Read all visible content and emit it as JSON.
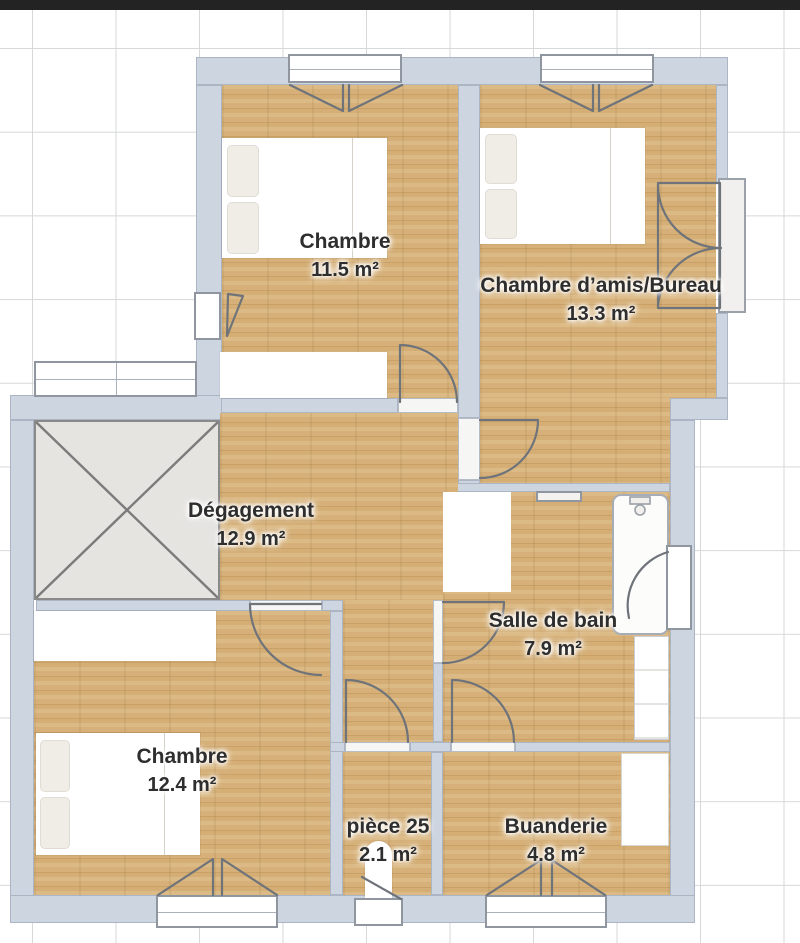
{
  "rooms": [
    {
      "id": "chambre-1",
      "name": "Chambre",
      "area": "11.5 m²"
    },
    {
      "id": "chambre-amis",
      "name": "Chambre d’amis/Bureau",
      "area": "13.3 m²"
    },
    {
      "id": "degagement",
      "name": "Dégagement",
      "area": "12.9 m²"
    },
    {
      "id": "salle-de-bain",
      "name": "Salle de bain",
      "area": "7.9 m²"
    },
    {
      "id": "chambre-2",
      "name": "Chambre",
      "area": "12.4 m²"
    },
    {
      "id": "piece-25",
      "name": "pièce 25",
      "area": "2.1 m²"
    },
    {
      "id": "buanderie",
      "name": "Buanderie",
      "area": "4.8 m²"
    }
  ],
  "colors": {
    "wall": "#cdd5e0",
    "floor_wood": "#d6b17a",
    "stairwell": "#e6e4e1",
    "grid_line": "#d6d8da",
    "top_bar": "#232323",
    "label_text": "#2e2e2e"
  }
}
